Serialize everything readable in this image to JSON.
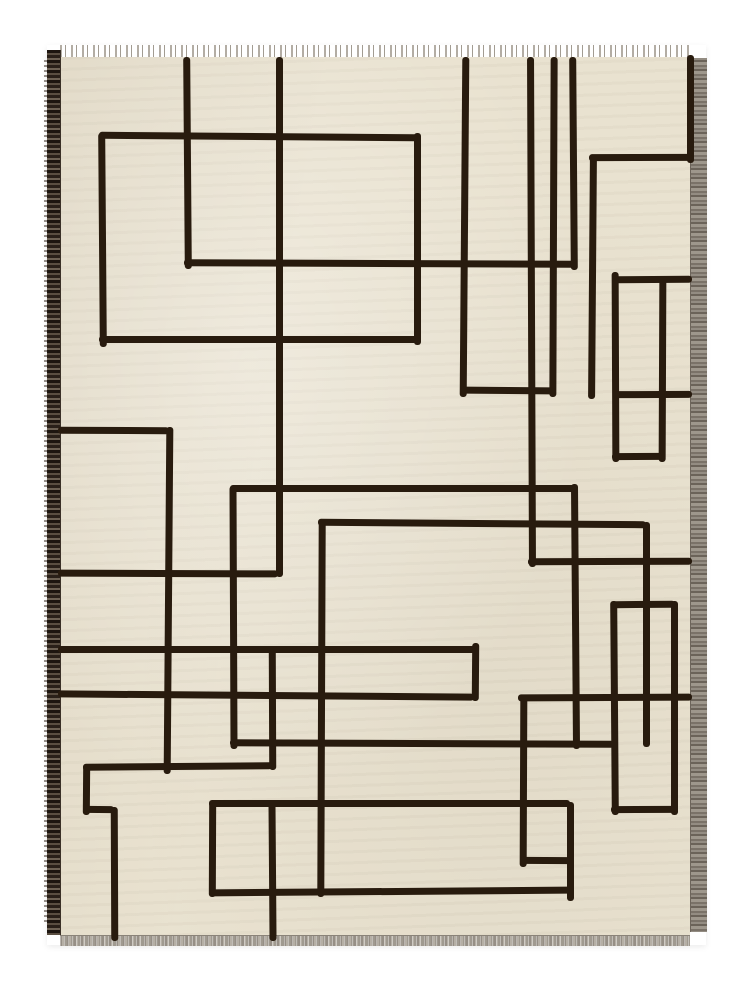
{
  "image_type": "photograph",
  "subject": "handwoven flatweave kilim rug with modernist black line grid pattern on cream ground",
  "scene": {
    "background_color": "#ffffff"
  },
  "rug": {
    "origin_x": 47,
    "origin_y": 45,
    "width": 659,
    "height": 900,
    "field": {
      "x": 60,
      "y": 57,
      "width": 630,
      "height": 878,
      "color": "#e9e2d0"
    },
    "line_color": "#281b0e",
    "line_thickness": 7,
    "left_selvage": {
      "x": 47,
      "y": 50,
      "width": 13,
      "height": 885,
      "style": "dark brown striped band with outer hairs"
    },
    "right_selvage": {
      "x": 690,
      "y": 58,
      "width": 16,
      "height": 874,
      "style": "gray striped band"
    },
    "top_fringe": {
      "y": 45,
      "height": 12,
      "style": "short gray warp tufts"
    },
    "bottom_fringe": {
      "y": 935,
      "height": 10,
      "style": "gray fringe strip"
    },
    "pattern_lines": {
      "verticals": [
        {
          "x": 184,
          "y1": 57,
          "y2": 262
        },
        {
          "x": 276,
          "y1": 57,
          "y2": 570
        },
        {
          "x": 461,
          "y1": 57,
          "y2": 390
        },
        {
          "x": 528,
          "y1": 57,
          "y2": 560
        },
        {
          "x": 550,
          "y1": 57,
          "y2": 390
        },
        {
          "x": 570,
          "y1": 57,
          "y2": 263
        },
        {
          "x": 687,
          "y1": 55,
          "y2": 156
        },
        {
          "x": 589,
          "y1": 155,
          "y2": 392
        },
        {
          "x": 612,
          "y1": 272,
          "y2": 455
        },
        {
          "x": 659,
          "y1": 278,
          "y2": 455
        },
        {
          "x": 99,
          "y1": 133,
          "y2": 340
        },
        {
          "x": 414,
          "y1": 133,
          "y2": 338
        },
        {
          "x": 165,
          "y1": 427,
          "y2": 767
        },
        {
          "x": 230,
          "y1": 486,
          "y2": 742
        },
        {
          "x": 318,
          "y1": 520,
          "y2": 890
        },
        {
          "x": 572,
          "y1": 484,
          "y2": 742
        },
        {
          "x": 643,
          "y1": 522,
          "y2": 740
        },
        {
          "x": 472,
          "y1": 643,
          "y2": 694
        },
        {
          "x": 269,
          "y1": 648,
          "y2": 763
        },
        {
          "x": 520,
          "y1": 695,
          "y2": 860
        },
        {
          "x": 611,
          "y1": 601,
          "y2": 808
        },
        {
          "x": 671,
          "y1": 601,
          "y2": 808
        },
        {
          "x": 83,
          "y1": 764,
          "y2": 808
        },
        {
          "x": 111,
          "y1": 807,
          "y2": 934
        },
        {
          "x": 209,
          "y1": 801,
          "y2": 890
        },
        {
          "x": 269,
          "y1": 800,
          "y2": 934
        },
        {
          "x": 567,
          "y1": 802,
          "y2": 894
        }
      ],
      "horizontals": [
        {
          "y": 133,
          "x1": 99,
          "x2": 418
        },
        {
          "y": 154,
          "x1": 589,
          "x2": 692
        },
        {
          "y": 260,
          "x1": 184,
          "x2": 574
        },
        {
          "y": 276,
          "x1": 612,
          "x2": 692
        },
        {
          "y": 336,
          "x1": 99,
          "x2": 418
        },
        {
          "y": 387,
          "x1": 461,
          "x2": 555
        },
        {
          "y": 391,
          "x1": 613,
          "x2": 692
        },
        {
          "y": 427,
          "x1": 58,
          "x2": 169
        },
        {
          "y": 453,
          "x1": 612,
          "x2": 662
        },
        {
          "y": 485,
          "x1": 230,
          "x2": 576
        },
        {
          "y": 520,
          "x1": 318,
          "x2": 646
        },
        {
          "y": 558,
          "x1": 528,
          "x2": 692
        },
        {
          "y": 570,
          "x1": 58,
          "x2": 278
        },
        {
          "y": 601,
          "x1": 611,
          "x2": 675
        },
        {
          "y": 646,
          "x1": 58,
          "x2": 476
        },
        {
          "y": 692,
          "x1": 58,
          "x2": 474
        },
        {
          "y": 694,
          "x1": 518,
          "x2": 692
        },
        {
          "y": 740,
          "x1": 230,
          "x2": 614
        },
        {
          "y": 763,
          "x1": 83,
          "x2": 272
        },
        {
          "y": 800,
          "x1": 209,
          "x2": 570
        },
        {
          "y": 806,
          "x1": 83,
          "x2": 114
        },
        {
          "y": 806,
          "x1": 611,
          "x2": 675
        },
        {
          "y": 857,
          "x1": 520,
          "x2": 570
        },
        {
          "y": 888,
          "x1": 209,
          "x2": 570
        }
      ]
    }
  }
}
